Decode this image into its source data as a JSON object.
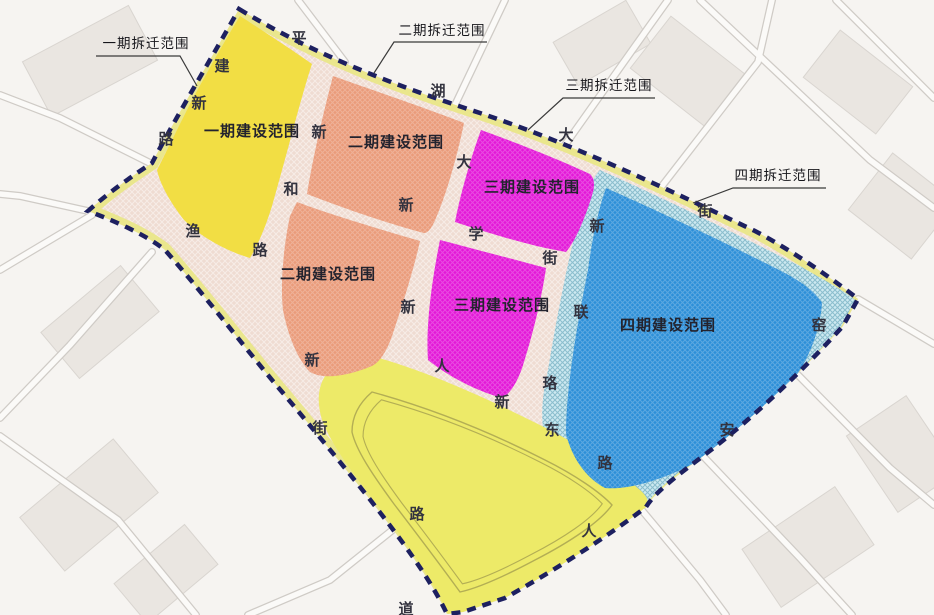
{
  "map": {
    "type": "urban-planning-phase-map",
    "colors": {
      "phase1_construction_yellow": "#f2de44",
      "phase2_construction_orange": "#ea9b7a",
      "phase3_construction_magenta": "#e318d8",
      "phase4_construction_blue": "#2d8fd8",
      "phase4_hatch_lightblue": "#cde9f1",
      "demolition_band_yellow": "#e9e784",
      "boundary_navy": "#1d2060",
      "inner_road_pink": "#efdcd2",
      "bottom_wedge_yellow": "#edea68",
      "background": "#f6f4f1"
    },
    "region_labels": [
      {
        "text": "一期建设范围"
      },
      {
        "text": "二期建设范围"
      },
      {
        "text": "三期建设范围"
      },
      {
        "text": "二期建设范围"
      },
      {
        "text": "三期建设范围"
      },
      {
        "text": "四期建设范围"
      }
    ],
    "callouts": [
      {
        "text": "一期拆迁范围"
      },
      {
        "text": "二期拆迁范围"
      },
      {
        "text": "三期拆迁范围"
      },
      {
        "text": "四期拆迁范围"
      }
    ],
    "road_chars": [
      {
        "ch": "平"
      },
      {
        "ch": "湖"
      },
      {
        "ch": "大"
      },
      {
        "ch": "街"
      },
      {
        "ch": "窑"
      },
      {
        "ch": "安"
      },
      {
        "ch": "人"
      },
      {
        "ch": "建"
      },
      {
        "ch": "新"
      },
      {
        "ch": "路"
      },
      {
        "ch": "渔"
      },
      {
        "ch": "新"
      },
      {
        "ch": "和"
      },
      {
        "ch": "路"
      },
      {
        "ch": "大"
      },
      {
        "ch": "新"
      },
      {
        "ch": "学"
      },
      {
        "ch": "街"
      },
      {
        "ch": "新"
      },
      {
        "ch": "联"
      },
      {
        "ch": "珞"
      },
      {
        "ch": "新"
      },
      {
        "ch": "新"
      },
      {
        "ch": "街"
      },
      {
        "ch": "路"
      },
      {
        "ch": "人"
      },
      {
        "ch": "新"
      },
      {
        "ch": "东"
      },
      {
        "ch": "路"
      },
      {
        "ch": "道"
      }
    ]
  }
}
